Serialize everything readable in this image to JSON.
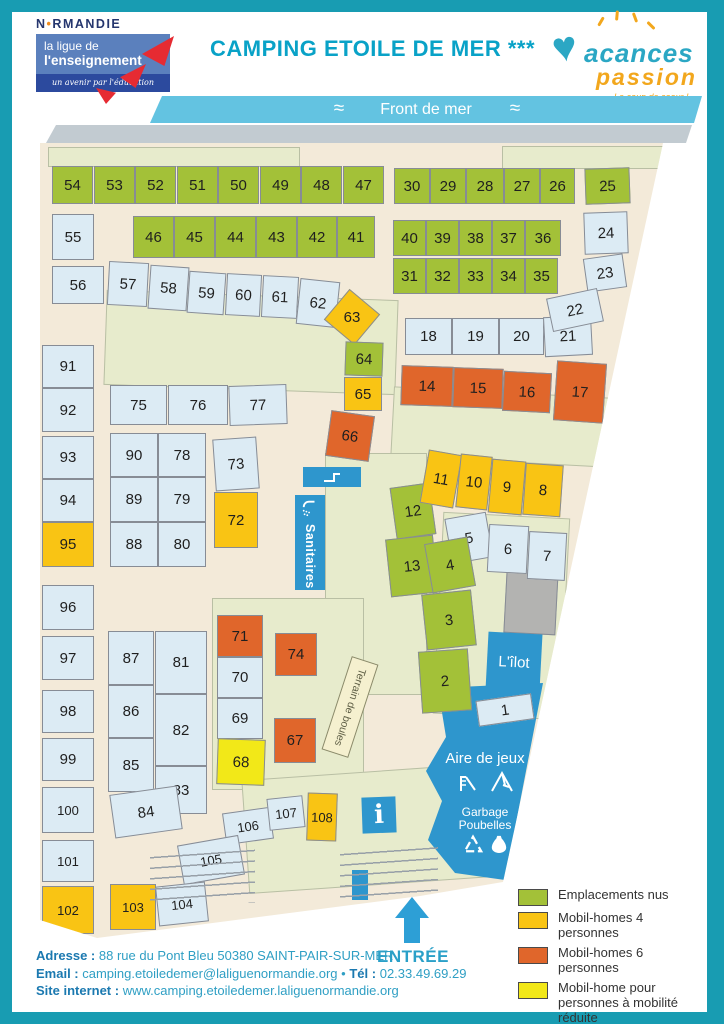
{
  "colors": {
    "g": "#a3c138",
    "m4": "#f9c414",
    "m6": "#e0662b",
    "pmr": "#f2e818",
    "pv": "#dcebf4",
    "frame_teal": "#189cb2",
    "accent_teal": "#09a2c7",
    "building_blue": "#2e96cd",
    "banner_blue": "#63c3e1",
    "promenade_grey": "#c2cbd1",
    "map_beige": "#f3ead9",
    "grass_olive": "#e7ebcc"
  },
  "header": {
    "normandie_n": "N",
    "normandie_dot": "•",
    "normandie_rest": "RMANDIE",
    "ligue_line1": "la ligue de",
    "ligue_line2": "l'enseignement",
    "ligue_tagline": "un avenir par l'éducation populaire",
    "title": "CAMPING ETOILE DE MER ***",
    "brand_word1": "acances",
    "brand_heart": "♥",
    "brand_word2": "passion",
    "brand_tagline": "Le coup de coeur !"
  },
  "map": {
    "icons": {
      "wave": "≈"
    },
    "labels": {
      "front": "Front de mer",
      "sanitaires": "Sanitaires",
      "terrain": "Terrain de boules",
      "ilot": "L'îlot",
      "aire": "Aire de jeux",
      "garbage": "Garbage",
      "poubelles": "Poubelles",
      "info": "i",
      "entree": "ENTRÉE"
    },
    "plots": [
      {
        "n": 54,
        "c": "g",
        "x": 12,
        "y": 23,
        "w": 41,
        "h": 38
      },
      {
        "n": 53,
        "c": "g",
        "x": 54,
        "y": 23,
        "w": 41,
        "h": 38
      },
      {
        "n": 52,
        "c": "g",
        "x": 95,
        "y": 23,
        "w": 41,
        "h": 38
      },
      {
        "n": 51,
        "c": "g",
        "x": 137,
        "y": 23,
        "w": 41,
        "h": 38
      },
      {
        "n": 50,
        "c": "g",
        "x": 178,
        "y": 23,
        "w": 41,
        "h": 38
      },
      {
        "n": 49,
        "c": "g",
        "x": 220,
        "y": 23,
        "w": 41,
        "h": 38
      },
      {
        "n": 48,
        "c": "g",
        "x": 261,
        "y": 23,
        "w": 41,
        "h": 38
      },
      {
        "n": 47,
        "c": "g",
        "x": 303,
        "y": 23,
        "w": 41,
        "h": 38
      },
      {
        "n": 30,
        "c": "g",
        "x": 354,
        "y": 25,
        "w": 36,
        "h": 36
      },
      {
        "n": 29,
        "c": "g",
        "x": 390,
        "y": 25,
        "w": 36,
        "h": 36
      },
      {
        "n": 28,
        "c": "g",
        "x": 426,
        "y": 25,
        "w": 38,
        "h": 36
      },
      {
        "n": 27,
        "c": "g",
        "x": 464,
        "y": 25,
        "w": 36,
        "h": 36
      },
      {
        "n": 26,
        "c": "g",
        "x": 500,
        "y": 25,
        "w": 35,
        "h": 36
      },
      {
        "n": 25,
        "c": "g",
        "x": 545,
        "y": 25,
        "w": 45,
        "h": 36,
        "r": -2
      },
      {
        "n": 55,
        "c": "pv",
        "x": 12,
        "y": 71,
        "w": 42,
        "h": 46
      },
      {
        "n": 46,
        "c": "g",
        "x": 93,
        "y": 73,
        "w": 41,
        "h": 42
      },
      {
        "n": 45,
        "c": "g",
        "x": 134,
        "y": 73,
        "w": 41,
        "h": 42
      },
      {
        "n": 44,
        "c": "g",
        "x": 175,
        "y": 73,
        "w": 41,
        "h": 42
      },
      {
        "n": 43,
        "c": "g",
        "x": 216,
        "y": 73,
        "w": 41,
        "h": 42
      },
      {
        "n": 42,
        "c": "g",
        "x": 257,
        "y": 73,
        "w": 40,
        "h": 42
      },
      {
        "n": 41,
        "c": "g",
        "x": 297,
        "y": 73,
        "w": 38,
        "h": 42
      },
      {
        "n": 40,
        "c": "g",
        "x": 353,
        "y": 77,
        "w": 33,
        "h": 36
      },
      {
        "n": 39,
        "c": "g",
        "x": 386,
        "y": 77,
        "w": 33,
        "h": 36
      },
      {
        "n": 38,
        "c": "g",
        "x": 419,
        "y": 77,
        "w": 33,
        "h": 36
      },
      {
        "n": 37,
        "c": "g",
        "x": 452,
        "y": 77,
        "w": 33,
        "h": 36
      },
      {
        "n": 36,
        "c": "g",
        "x": 485,
        "y": 77,
        "w": 36,
        "h": 36
      },
      {
        "n": 24,
        "c": "pv",
        "x": 544,
        "y": 69,
        "w": 44,
        "h": 42,
        "r": -2
      },
      {
        "n": 56,
        "c": "pv",
        "x": 12,
        "y": 123,
        "w": 52,
        "h": 38
      },
      {
        "n": 57,
        "c": "pv",
        "x": 68,
        "y": 119,
        "w": 40,
        "h": 44,
        "r": 3
      },
      {
        "n": 58,
        "c": "pv",
        "x": 109,
        "y": 123,
        "w": 39,
        "h": 44,
        "r": 4
      },
      {
        "n": 59,
        "c": "pv",
        "x": 148,
        "y": 129,
        "w": 37,
        "h": 42,
        "r": 4
      },
      {
        "n": 60,
        "c": "pv",
        "x": 186,
        "y": 131,
        "w": 35,
        "h": 42,
        "r": 3
      },
      {
        "n": 61,
        "c": "pv",
        "x": 222,
        "y": 133,
        "w": 36,
        "h": 42,
        "r": 3
      },
      {
        "n": 62,
        "c": "pv",
        "x": 258,
        "y": 137,
        "w": 40,
        "h": 46,
        "r": 6
      },
      {
        "n": 31,
        "c": "g",
        "x": 353,
        "y": 115,
        "w": 33,
        "h": 36
      },
      {
        "n": 32,
        "c": "g",
        "x": 386,
        "y": 115,
        "w": 33,
        "h": 36
      },
      {
        "n": 33,
        "c": "g",
        "x": 419,
        "y": 115,
        "w": 33,
        "h": 36
      },
      {
        "n": 34,
        "c": "g",
        "x": 452,
        "y": 115,
        "w": 33,
        "h": 36
      },
      {
        "n": 35,
        "c": "g",
        "x": 485,
        "y": 115,
        "w": 33,
        "h": 36
      },
      {
        "n": 23,
        "c": "pv",
        "x": 545,
        "y": 113,
        "w": 40,
        "h": 34,
        "r": -8
      },
      {
        "n": 63,
        "c": "m4",
        "x": 292,
        "y": 154,
        "w": 40,
        "h": 40,
        "r": 40
      },
      {
        "n": 18,
        "c": "pv",
        "x": 365,
        "y": 175,
        "w": 47,
        "h": 37
      },
      {
        "n": 19,
        "c": "pv",
        "x": 412,
        "y": 175,
        "w": 47,
        "h": 37
      },
      {
        "n": 20,
        "c": "pv",
        "x": 459,
        "y": 175,
        "w": 45,
        "h": 37
      },
      {
        "n": 21,
        "c": "pv",
        "x": 504,
        "y": 173,
        "w": 48,
        "h": 40,
        "r": -3
      },
      {
        "n": 22,
        "c": "pv",
        "x": 509,
        "y": 150,
        "w": 52,
        "h": 34,
        "r": -12
      },
      {
        "n": 64,
        "c": "g",
        "x": 305,
        "y": 199,
        "w": 38,
        "h": 34,
        "r": 2
      },
      {
        "n": 65,
        "c": "m4",
        "x": 304,
        "y": 234,
        "w": 38,
        "h": 34
      },
      {
        "n": 66,
        "c": "m6",
        "x": 288,
        "y": 270,
        "w": 44,
        "h": 46,
        "r": 8
      },
      {
        "n": 14,
        "c": "m6",
        "x": 361,
        "y": 223,
        "w": 52,
        "h": 40,
        "r": 2
      },
      {
        "n": 15,
        "c": "m6",
        "x": 413,
        "y": 225,
        "w": 50,
        "h": 40,
        "r": 2
      },
      {
        "n": 16,
        "c": "m6",
        "x": 463,
        "y": 229,
        "w": 48,
        "h": 40,
        "r": 3
      },
      {
        "n": 17,
        "c": "m6",
        "x": 515,
        "y": 219,
        "w": 50,
        "h": 60,
        "r": 4
      },
      {
        "n": 91,
        "c": "pv",
        "x": 2,
        "y": 202,
        "w": 52,
        "h": 43
      },
      {
        "n": 92,
        "c": "pv",
        "x": 2,
        "y": 245,
        "w": 52,
        "h": 44
      },
      {
        "n": 93,
        "c": "pv",
        "x": 2,
        "y": 293,
        "w": 52,
        "h": 43
      },
      {
        "n": 94,
        "c": "pv",
        "x": 2,
        "y": 336,
        "w": 52,
        "h": 43
      },
      {
        "n": 95,
        "c": "m4",
        "x": 2,
        "y": 379,
        "w": 52,
        "h": 45
      },
      {
        "n": 96,
        "c": "pv",
        "x": 2,
        "y": 442,
        "w": 52,
        "h": 45
      },
      {
        "n": 97,
        "c": "pv",
        "x": 2,
        "y": 493,
        "w": 52,
        "h": 44
      },
      {
        "n": 98,
        "c": "pv",
        "x": 2,
        "y": 547,
        "w": 52,
        "h": 43
      },
      {
        "n": 99,
        "c": "pv",
        "x": 2,
        "y": 595,
        "w": 52,
        "h": 43
      },
      {
        "n": 100,
        "c": "pv",
        "x": 2,
        "y": 644,
        "w": 52,
        "h": 46
      },
      {
        "n": 101,
        "c": "pv",
        "x": 2,
        "y": 697,
        "w": 52,
        "h": 42
      },
      {
        "n": 102,
        "c": "m4",
        "x": 2,
        "y": 743,
        "w": 52,
        "h": 48
      },
      {
        "n": 75,
        "c": "pv",
        "x": 70,
        "y": 242,
        "w": 57,
        "h": 40
      },
      {
        "n": 76,
        "c": "pv",
        "x": 128,
        "y": 242,
        "w": 60,
        "h": 40
      },
      {
        "n": 77,
        "c": "pv",
        "x": 189,
        "y": 242,
        "w": 58,
        "h": 40,
        "r": -2
      },
      {
        "n": 90,
        "c": "pv",
        "x": 70,
        "y": 290,
        "w": 48,
        "h": 44
      },
      {
        "n": 78,
        "c": "pv",
        "x": 118,
        "y": 290,
        "w": 48,
        "h": 44
      },
      {
        "n": 89,
        "c": "pv",
        "x": 70,
        "y": 334,
        "w": 48,
        "h": 45
      },
      {
        "n": 79,
        "c": "pv",
        "x": 118,
        "y": 334,
        "w": 48,
        "h": 45
      },
      {
        "n": 88,
        "c": "pv",
        "x": 70,
        "y": 379,
        "w": 48,
        "h": 45
      },
      {
        "n": 80,
        "c": "pv",
        "x": 118,
        "y": 379,
        "w": 48,
        "h": 45
      },
      {
        "n": 73,
        "c": "pv",
        "x": 174,
        "y": 295,
        "w": 44,
        "h": 52,
        "r": -4
      },
      {
        "n": 72,
        "c": "m4",
        "x": 174,
        "y": 349,
        "w": 44,
        "h": 56
      },
      {
        "n": 12,
        "c": "g",
        "x": 353,
        "y": 342,
        "w": 40,
        "h": 52,
        "r": -8
      },
      {
        "n": 13,
        "c": "g",
        "x": 348,
        "y": 394,
        "w": 48,
        "h": 58,
        "r": -6
      },
      {
        "n": 11,
        "c": "m4",
        "x": 384,
        "y": 309,
        "w": 34,
        "h": 54,
        "r": 10
      },
      {
        "n": 10,
        "c": "m4",
        "x": 418,
        "y": 312,
        "w": 32,
        "h": 54,
        "r": 6
      },
      {
        "n": 9,
        "c": "m4",
        "x": 450,
        "y": 317,
        "w": 34,
        "h": 54,
        "r": 5
      },
      {
        "n": 8,
        "c": "m4",
        "x": 484,
        "y": 321,
        "w": 38,
        "h": 52,
        "r": 4
      },
      {
        "n": 5,
        "c": "pv",
        "x": 408,
        "y": 372,
        "w": 42,
        "h": 46,
        "r": -10
      },
      {
        "n": 6,
        "c": "pv",
        "x": 448,
        "y": 382,
        "w": 40,
        "h": 48,
        "r": 3
      },
      {
        "n": 7,
        "c": "pv",
        "x": 488,
        "y": 389,
        "w": 38,
        "h": 48,
        "r": 3
      },
      {
        "n": 4,
        "c": "g",
        "x": 388,
        "y": 397,
        "w": 44,
        "h": 50,
        "r": -10
      },
      {
        "n": 3,
        "c": "g",
        "x": 384,
        "y": 449,
        "w": 50,
        "h": 56,
        "r": -6
      },
      {
        "n": 2,
        "c": "g",
        "x": 380,
        "y": 507,
        "w": 50,
        "h": 62,
        "r": -4
      },
      {
        "n": 1,
        "c": "pv",
        "x": 437,
        "y": 554,
        "w": 56,
        "h": 26,
        "r": -8
      },
      {
        "n": 71,
        "c": "m6",
        "x": 177,
        "y": 472,
        "w": 46,
        "h": 42
      },
      {
        "n": 70,
        "c": "pv",
        "x": 177,
        "y": 514,
        "w": 46,
        "h": 41
      },
      {
        "n": 69,
        "c": "pv",
        "x": 177,
        "y": 555,
        "w": 46,
        "h": 41
      },
      {
        "n": 68,
        "c": "pmr",
        "x": 177,
        "y": 596,
        "w": 48,
        "h": 46,
        "r": 2
      },
      {
        "n": 74,
        "c": "m6",
        "x": 235,
        "y": 490,
        "w": 42,
        "h": 43
      },
      {
        "n": 67,
        "c": "m6",
        "x": 234,
        "y": 575,
        "w": 42,
        "h": 45
      },
      {
        "n": 87,
        "c": "pv",
        "x": 68,
        "y": 488,
        "w": 46,
        "h": 54
      },
      {
        "n": 81,
        "c": "pv",
        "x": 115,
        "y": 488,
        "w": 52,
        "h": 63
      },
      {
        "n": 86,
        "c": "pv",
        "x": 68,
        "y": 542,
        "w": 46,
        "h": 53
      },
      {
        "n": 82,
        "c": "pv",
        "x": 115,
        "y": 551,
        "w": 52,
        "h": 72
      },
      {
        "n": 85,
        "c": "pv",
        "x": 68,
        "y": 595,
        "w": 46,
        "h": 54
      },
      {
        "n": 83,
        "c": "pv",
        "x": 115,
        "y": 623,
        "w": 52,
        "h": 48
      },
      {
        "n": 84,
        "c": "pv",
        "x": 72,
        "y": 647,
        "w": 68,
        "h": 44,
        "r": -8
      },
      {
        "n": 106,
        "c": "pv",
        "x": 184,
        "y": 667,
        "w": 48,
        "h": 32,
        "r": -8
      },
      {
        "n": 107,
        "c": "pv",
        "x": 228,
        "y": 654,
        "w": 36,
        "h": 32,
        "r": -6
      },
      {
        "n": 108,
        "c": "m4",
        "x": 267,
        "y": 650,
        "w": 30,
        "h": 48,
        "r": 2
      },
      {
        "n": 105,
        "c": "pv",
        "x": 140,
        "y": 697,
        "w": 62,
        "h": 40,
        "r": -10
      },
      {
        "n": 104,
        "c": "pv",
        "x": 117,
        "y": 741,
        "w": 50,
        "h": 40,
        "r": -6
      },
      {
        "n": 103,
        "c": "m4",
        "x": 70,
        "y": 741,
        "w": 46,
        "h": 46
      }
    ]
  },
  "legend": {
    "items": [
      {
        "label": "Emplacements nus",
        "color": "#a3c138"
      },
      {
        "label": "Mobil-homes 4 personnes",
        "color": "#f9c414"
      },
      {
        "label": "Mobil-homes 6 personnes",
        "color": "#e0662b"
      },
      {
        "label": "Mobil-home pour personnes à mobilité réduite",
        "color": "#f2e818"
      },
      {
        "label": "Privé",
        "color": "#dcebf4"
      }
    ]
  },
  "footer": {
    "address_label": "Adresse :",
    "address": "88 rue du Pont Bleu 50380 SAINT-PAIR-SUR-MER",
    "email_label": "Email :",
    "email": "camping.etoiledemer@laliguenormandie.org",
    "separator": "•",
    "tel_label": "Tél :",
    "tel": "02.33.49.69.29",
    "site_label": "Site internet :",
    "site": "www.camping.etoiledemer.laliguenormandie.org"
  }
}
